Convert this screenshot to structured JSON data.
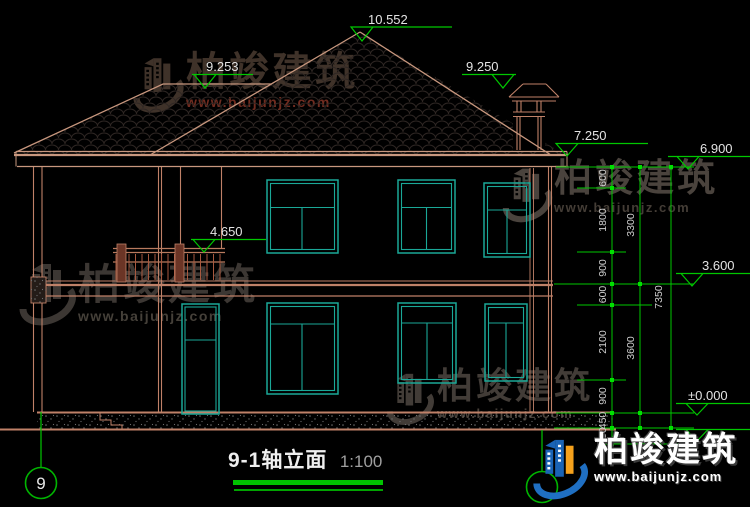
{
  "drawing": {
    "title": "9-1轴立面",
    "scale": "1:100",
    "grid_left_label": "9",
    "elevations": {
      "ridge": "10.552",
      "left_ridge": "9.253",
      "chimney": "9.250",
      "eave_fascia": "7.250",
      "eave": "6.900",
      "balcony_rail": "4.650",
      "second_floor": "3.600",
      "ground_floor": "±0.000"
    },
    "dims": {
      "inner": [
        "600",
        "1800",
        "900",
        "600",
        "2100",
        "900",
        "450",
        "450"
      ],
      "mid": [
        "3300",
        "3600"
      ],
      "outer": [
        "7350"
      ]
    }
  },
  "watermark": {
    "brand": "柏竣建筑",
    "site": "www.baijunjz.com"
  },
  "colors": {
    "background": "#000000",
    "outline": "#bf8168",
    "roof_edge": "#c8977e",
    "window": "#1aa897",
    "dimension": "#00c800",
    "text": "#e3e3e3",
    "logo_blue": "#1a63b5",
    "logo_orange": "#f5a11c"
  }
}
